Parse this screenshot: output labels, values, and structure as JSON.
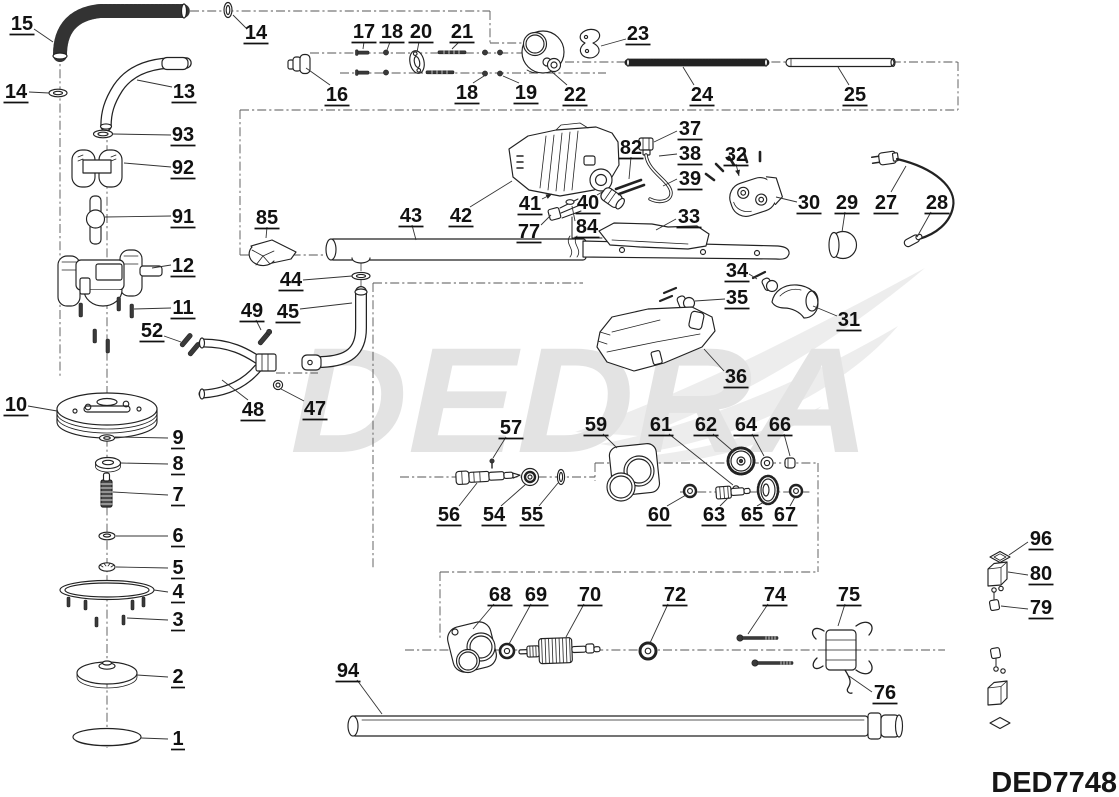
{
  "diagram": {
    "watermark": "DEDRA",
    "model_code": "DED7748",
    "ink_color": "#222222",
    "watermark_color": "#e3e3e3",
    "labels": [
      {
        "n": "15",
        "x": 22,
        "y": 23,
        "leader": [
          34,
          29,
          53,
          42
        ]
      },
      {
        "n": "14",
        "x": 256,
        "y": 32,
        "leader": [
          247,
          29,
          233,
          15
        ]
      },
      {
        "n": "14",
        "x": 16,
        "y": 91,
        "leader": [
          29,
          92,
          49,
          93
        ]
      },
      {
        "n": "13",
        "x": 184,
        "y": 91,
        "leader": [
          172,
          87,
          137,
          80
        ]
      },
      {
        "n": "16",
        "x": 337,
        "y": 94,
        "leader": [
          330,
          85,
          306,
          68
        ]
      },
      {
        "n": "17",
        "x": 364,
        "y": 31,
        "leader": [
          364,
          42,
          363,
          49
        ]
      },
      {
        "n": "18",
        "x": 392,
        "y": 31,
        "leader": [
          390,
          42,
          387,
          50
        ]
      },
      {
        "n": "20",
        "x": 421,
        "y": 31,
        "leader": [
          419,
          42,
          417,
          52
        ]
      },
      {
        "n": "21",
        "x": 462,
        "y": 31,
        "leader": [
          459,
          42,
          452,
          49
        ]
      },
      {
        "n": "18",
        "x": 467,
        "y": 92,
        "leader": [
          473,
          83,
          484,
          76
        ]
      },
      {
        "n": "19",
        "x": 526,
        "y": 92,
        "leader": [
          519,
          83,
          503,
          76
        ]
      },
      {
        "n": "22",
        "x": 575,
        "y": 94,
        "leader": [
          567,
          85,
          551,
          71
        ]
      },
      {
        "n": "23",
        "x": 638,
        "y": 33,
        "leader": [
          626,
          39,
          601,
          46
        ]
      },
      {
        "n": "24",
        "x": 702,
        "y": 94,
        "leader": [
          694,
          85,
          683,
          67
        ]
      },
      {
        "n": "25",
        "x": 855,
        "y": 94,
        "leader": [
          849,
          85,
          838,
          67
        ]
      },
      {
        "n": "27",
        "x": 886,
        "y": 202,
        "leader": [
          891,
          192,
          906,
          166
        ]
      },
      {
        "n": "28",
        "x": 937,
        "y": 202,
        "leader": [
          931,
          212,
          917,
          237
        ]
      },
      {
        "n": "29",
        "x": 847,
        "y": 202,
        "leader": [
          845,
          212,
          842,
          232
        ]
      },
      {
        "n": "30",
        "x": 809,
        "y": 202,
        "leader": [
          797,
          202,
          776,
          197
        ]
      },
      {
        "n": "32",
        "x": 736,
        "y": 154,
        "leader": [
          736,
          164,
          739,
          176
        ],
        "arrow": true
      },
      {
        "n": "37",
        "x": 690,
        "y": 128,
        "leader": [
          677,
          131,
          654,
          142
        ]
      },
      {
        "n": "38",
        "x": 690,
        "y": 153,
        "leader": [
          677,
          154,
          659,
          156
        ]
      },
      {
        "n": "39",
        "x": 690,
        "y": 178,
        "leader": [
          677,
          179,
          663,
          186
        ]
      },
      {
        "n": "82",
        "x": 631,
        "y": 147,
        "leader": [
          631,
          157,
          629,
          179
        ]
      },
      {
        "n": "33",
        "x": 689,
        "y": 216,
        "leader": [
          676,
          219,
          656,
          230
        ]
      },
      {
        "n": "41",
        "x": 530,
        "y": 203,
        "leader": [
          542,
          199,
          552,
          194
        ],
        "arrow": true
      },
      {
        "n": "40",
        "x": 588,
        "y": 202,
        "leader": [
          597,
          195,
          604,
          191
        ]
      },
      {
        "n": "84",
        "x": 587,
        "y": 226,
        "leader": [
          575,
          221,
          572,
          206
        ]
      },
      {
        "n": "77",
        "x": 529,
        "y": 231,
        "leader": [
          541,
          225,
          551,
          215
        ]
      },
      {
        "n": "42",
        "x": 461,
        "y": 215,
        "leader": [
          470,
          207,
          512,
          181
        ]
      },
      {
        "n": "43",
        "x": 411,
        "y": 215,
        "leader": [
          412,
          225,
          416,
          240
        ]
      },
      {
        "n": "85",
        "x": 267,
        "y": 217,
        "leader": [
          267,
          227,
          266,
          238
        ]
      },
      {
        "n": "44",
        "x": 291,
        "y": 279,
        "leader": [
          303,
          280,
          352,
          276
        ]
      },
      {
        "n": "45",
        "x": 288,
        "y": 311,
        "leader": [
          300,
          309,
          352,
          303
        ]
      },
      {
        "n": "49",
        "x": 252,
        "y": 310,
        "leader": [
          256,
          320,
          261,
          330
        ]
      },
      {
        "n": "12",
        "x": 183,
        "y": 265,
        "leader": [
          171,
          265,
          152,
          268
        ]
      },
      {
        "n": "11",
        "x": 183,
        "y": 307,
        "leader": [
          171,
          308,
          134,
          309
        ]
      },
      {
        "n": "52",
        "x": 152,
        "y": 330,
        "leader": [
          164,
          336,
          181,
          342
        ]
      },
      {
        "n": "93",
        "x": 183,
        "y": 134,
        "leader": [
          171,
          135,
          113,
          134
        ]
      },
      {
        "n": "92",
        "x": 183,
        "y": 167,
        "leader": [
          171,
          167,
          124,
          163
        ]
      },
      {
        "n": "91",
        "x": 183,
        "y": 216,
        "leader": [
          171,
          216,
          105,
          217
        ]
      },
      {
        "n": "10",
        "x": 16,
        "y": 404,
        "leader": [
          28,
          406,
          57,
          411
        ]
      },
      {
        "n": "48",
        "x": 253,
        "y": 409,
        "leader": [
          248,
          400,
          222,
          380
        ]
      },
      {
        "n": "47",
        "x": 315,
        "y": 408,
        "leader": [
          304,
          401,
          281,
          389
        ]
      },
      {
        "n": "9",
        "x": 178,
        "y": 437,
        "leader": [
          168,
          438,
          115,
          437
        ]
      },
      {
        "n": "8",
        "x": 178,
        "y": 463,
        "leader": [
          168,
          464,
          121,
          463
        ]
      },
      {
        "n": "7",
        "x": 178,
        "y": 494,
        "leader": [
          168,
          495,
          113,
          492
        ]
      },
      {
        "n": "6",
        "x": 178,
        "y": 535,
        "leader": [
          168,
          536,
          116,
          536
        ]
      },
      {
        "n": "5",
        "x": 178,
        "y": 567,
        "leader": [
          168,
          568,
          116,
          567
        ]
      },
      {
        "n": "4",
        "x": 178,
        "y": 591,
        "leader": [
          168,
          592,
          154,
          590
        ]
      },
      {
        "n": "3",
        "x": 178,
        "y": 619,
        "leader": [
          168,
          620,
          127,
          618
        ]
      },
      {
        "n": "2",
        "x": 178,
        "y": 676,
        "leader": [
          168,
          677,
          137,
          675
        ]
      },
      {
        "n": "1",
        "x": 178,
        "y": 738,
        "leader": [
          168,
          739,
          141,
          738
        ]
      },
      {
        "n": "94",
        "x": 348,
        "y": 670,
        "leader": [
          357,
          680,
          382,
          714
        ]
      },
      {
        "n": "57",
        "x": 511,
        "y": 427,
        "leader": [
          506,
          437,
          493,
          458
        ]
      },
      {
        "n": "56",
        "x": 449,
        "y": 514,
        "leader": [
          459,
          506,
          477,
          483
        ]
      },
      {
        "n": "54",
        "x": 494,
        "y": 514,
        "leader": [
          501,
          506,
          526,
          484
        ]
      },
      {
        "n": "55",
        "x": 532,
        "y": 514,
        "leader": [
          539,
          506,
          558,
          483
        ]
      },
      {
        "n": "59",
        "x": 596,
        "y": 424,
        "leader": [
          603,
          434,
          617,
          448
        ]
      },
      {
        "n": "61",
        "x": 661,
        "y": 424,
        "leader": [
          669,
          434,
          733,
          485
        ]
      },
      {
        "n": "62",
        "x": 706,
        "y": 424,
        "leader": [
          713,
          434,
          734,
          452
        ]
      },
      {
        "n": "64",
        "x": 746,
        "y": 424,
        "leader": [
          752,
          434,
          764,
          456
        ]
      },
      {
        "n": "66",
        "x": 780,
        "y": 424,
        "leader": [
          784,
          434,
          790,
          456
        ]
      },
      {
        "n": "60",
        "x": 659,
        "y": 514,
        "leader": [
          667,
          506,
          686,
          495
        ]
      },
      {
        "n": "63",
        "x": 714,
        "y": 514,
        "leader": [
          720,
          506,
          729,
          497
        ]
      },
      {
        "n": "65",
        "x": 752,
        "y": 514,
        "leader": [
          757,
          506,
          764,
          502
        ]
      },
      {
        "n": "67",
        "x": 785,
        "y": 514,
        "leader": [
          790,
          506,
          795,
          497
        ]
      },
      {
        "n": "68",
        "x": 500,
        "y": 594,
        "leader": [
          494,
          604,
          473,
          629
        ]
      },
      {
        "n": "69",
        "x": 536,
        "y": 594,
        "leader": [
          531,
          604,
          509,
          644
        ]
      },
      {
        "n": "70",
        "x": 590,
        "y": 594,
        "leader": [
          584,
          604,
          566,
          637
        ]
      },
      {
        "n": "72",
        "x": 675,
        "y": 594,
        "leader": [
          668,
          604,
          650,
          643
        ]
      },
      {
        "n": "74",
        "x": 775,
        "y": 594,
        "leader": [
          768,
          604,
          748,
          634
        ]
      },
      {
        "n": "75",
        "x": 849,
        "y": 594,
        "leader": [
          845,
          604,
          838,
          626
        ]
      },
      {
        "n": "76",
        "x": 885,
        "y": 692,
        "leader": [
          872,
          692,
          849,
          676
        ]
      },
      {
        "n": "96",
        "x": 1041,
        "y": 538,
        "leader": [
          1028,
          542,
          1009,
          555
        ]
      },
      {
        "n": "80",
        "x": 1041,
        "y": 573,
        "leader": [
          1028,
          575,
          1008,
          572
        ]
      },
      {
        "n": "79",
        "x": 1041,
        "y": 607,
        "leader": [
          1028,
          609,
          1001,
          606
        ]
      },
      {
        "n": "34",
        "x": 737,
        "y": 270,
        "leader": [
          749,
          274,
          757,
          279
        ]
      },
      {
        "n": "35",
        "x": 737,
        "y": 297,
        "leader": [
          725,
          299,
          695,
          301
        ]
      },
      {
        "n": "36",
        "x": 736,
        "y": 376,
        "leader": [
          724,
          371,
          704,
          349
        ]
      },
      {
        "n": "31",
        "x": 849,
        "y": 319,
        "leader": [
          837,
          316,
          813,
          306
        ]
      }
    ]
  }
}
